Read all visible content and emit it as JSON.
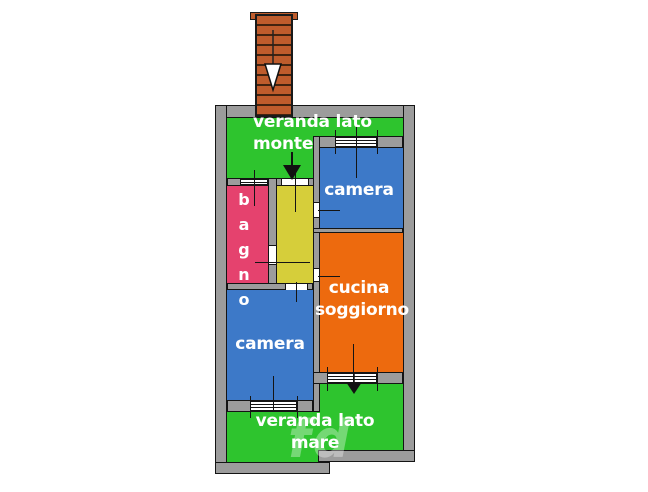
{
  "diagram_type": "apartment-floor-plan",
  "rooms": {
    "veranda_monte": {
      "label": "veranda lato\nmonte",
      "color": "#2ec42e"
    },
    "camera_top": {
      "label": "camera",
      "color": "#3d79c8"
    },
    "cucina": {
      "label": "cucina\nsoggiorno",
      "color": "#ed6a0e"
    },
    "bagno": {
      "label": "bagno",
      "color": "#e5426e"
    },
    "corridor": {
      "label": "",
      "color": "#d6ce3a"
    },
    "camera_bottom": {
      "label": "camera",
      "color": "#3d79c8"
    },
    "veranda_mare": {
      "label": "veranda lato\nmare",
      "color": "#2ec42e"
    }
  },
  "stairs": {
    "color": "#bf5c2c",
    "direction": "down"
  },
  "walls": {
    "color": "#9c9c9c",
    "outline": "#141414"
  },
  "watermark": {
    "text": "fd"
  }
}
